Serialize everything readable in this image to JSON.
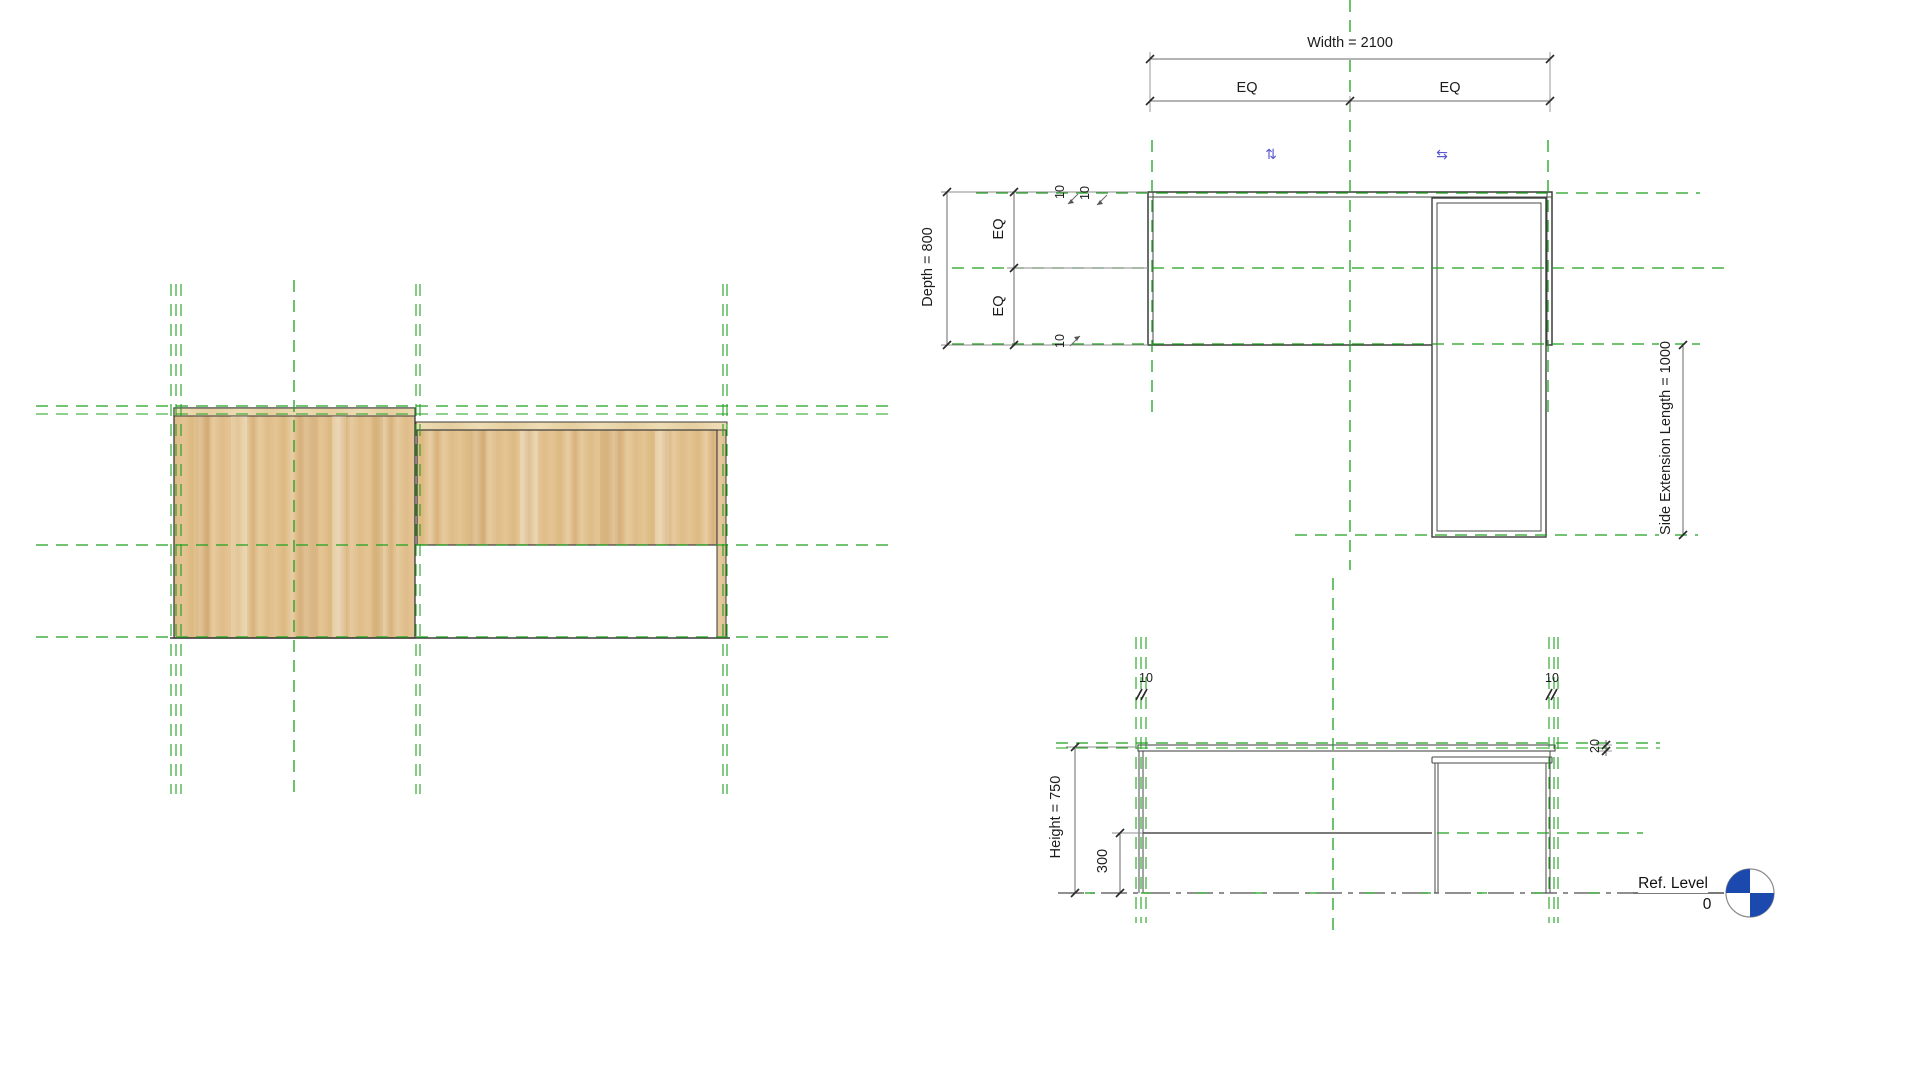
{
  "view": {
    "type": "revit-family-desk-drawing",
    "background": "#ffffff"
  },
  "colors": {
    "reference_plane_green": "#1fa11f",
    "drawing_line": "#3c3c3c",
    "dimension_line": "#6a6a6a",
    "text": "#1c1c1c",
    "flip_arrow_blue": "#5a5ace",
    "level_marker_blue": "#1c49ae",
    "wood_base": "#e2c08f",
    "wood_light": "#eedcb4",
    "wood_dark": "#d6ad77"
  },
  "plan": {
    "width_dim_label": "Width = 2100",
    "eq_top_left": "EQ",
    "eq_top_right": "EQ",
    "depth_dim_label": "Depth = 800",
    "eq_left_upper": "EQ",
    "eq_left_lower": "EQ",
    "offset_dim_top_a": "10",
    "offset_dim_top_b": "10",
    "offset_dim_bottom": "10",
    "side_extension_dim_label": "Side Extension Length = 1000",
    "flip_control_vertical": "⇅",
    "flip_control_horizontal": "⇆"
  },
  "elevation": {
    "height_dim_label": "Height = 750",
    "panel_height_dim": "300",
    "top_thickness_dim": "20",
    "leg_offset_left": "10",
    "leg_offset_right": "10",
    "ref_level_label": "Ref. Level",
    "ref_level_value": "0"
  }
}
